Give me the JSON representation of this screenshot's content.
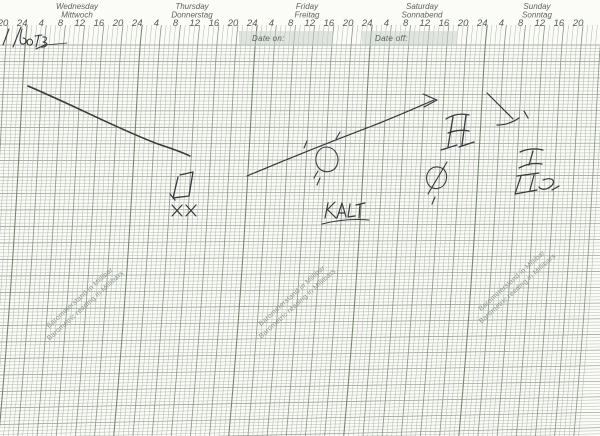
{
  "meta": {
    "title": "Scanned weekly barograph recording chart with handwritten pen annotations",
    "paper_color": "#fbfbf7"
  },
  "colors": {
    "grid_thin": "#adb6ab",
    "grid_major": "#879387",
    "grid_day": "#75826f",
    "header_text": "#5c635a",
    "hour_text": "#555c54",
    "watermark_text": "#8e988d",
    "date_box_fill": "#c8cfc7",
    "pen_ink": "#36393d"
  },
  "header": {
    "days": [
      {
        "en": "Wednesday",
        "de": "Mittwoch"
      },
      {
        "en": "Thursday",
        "de": "Donnerstag"
      },
      {
        "en": "Friday",
        "de": "Freitag"
      },
      {
        "en": "Saturday",
        "de": "Sonnabend"
      },
      {
        "en": "Sunday",
        "de": "Sonntag"
      }
    ],
    "hour_labels": [
      "20",
      "24",
      "4",
      "8",
      "12",
      "16",
      "20",
      "24",
      "4",
      "8",
      "12",
      "16",
      "20",
      "24",
      "4",
      "8",
      "12",
      "16",
      "20",
      "24",
      "4",
      "8",
      "12",
      "16",
      "20",
      "24",
      "4",
      "8",
      "12",
      "16",
      "20"
    ],
    "date_on_label": "Date on:",
    "date_off_label": "Date off:"
  },
  "watermark": {
    "line1": "Barometerstand in Millibar",
    "line2": "Barometric reading in Millibars",
    "instances": [
      {
        "x": 46,
        "y": 331
      },
      {
        "x": 258,
        "y": 329
      },
      {
        "x": 478,
        "y": 314
      }
    ],
    "angle_deg": -42
  },
  "handwriting": {
    "date_note": "1/6/73",
    "front_label": "KALT"
  },
  "chart_data": {
    "type": "line",
    "title": "",
    "x_axis": {
      "unit": "hours",
      "tick_interval_hours": 4,
      "hour_tick_labels": [
        "20",
        "24",
        "4",
        "8",
        "12",
        "16",
        "20",
        "24",
        "4",
        "8",
        "12",
        "16",
        "20",
        "24",
        "4",
        "8",
        "12",
        "16",
        "20",
        "24",
        "4",
        "8",
        "12",
        "16",
        "20",
        "24",
        "4",
        "8",
        "12",
        "16",
        "20"
      ],
      "days": [
        "Wednesday",
        "Thursday",
        "Friday",
        "Saturday",
        "Sunday"
      ]
    },
    "y_axis": {
      "label": "Barometric pressure (millibars)",
      "tick_labels_visible": false
    },
    "grid": {
      "time_lines": "curved hour arcs, heavier every 4 hours, heaviest at midnight (24)",
      "pressure_lines": "dense horizontal rules ~1 mb apart"
    },
    "series": [
      {
        "name": "pen-trace-falling",
        "trend": "falling",
        "start": {
          "day": "Wednesday",
          "hour": 1
        },
        "end": {
          "day": "Thursday",
          "hour": 11
        }
      },
      {
        "name": "pen-trace-rising-arrow",
        "trend": "rising",
        "arrowhead": true,
        "start": {
          "day": "Thursday",
          "hour": 23
        },
        "end": {
          "day": "Saturday",
          "hour": 15
        }
      }
    ],
    "annotations_text": [
      "1/6/73",
      "KALT",
      "Date on:",
      "Date off:"
    ]
  },
  "annotations": {
    "pen": [
      {
        "name": "handwritten-date",
        "w": 1.1,
        "d": "M3 45 L9 29 M13 47 L21 27 M22 29 C20 36 19 43 22 44 C27 45 28 38 23 38 M30 39 C27 39 26 44 29 45 C33 46 34 40 30 39 M35 36 L42 35 M39 35 L36 47 M43 37 C48 36 47 41 43 42 C49 42 47 48 41 47 M36 49 L47 44"
      },
      {
        "name": "handwritten-date-tail",
        "w": 0.7,
        "d": "M46 45 C54 44 60 44 67 43"
      },
      {
        "name": "falling-trace",
        "w": 1.5,
        "d": "M28 86 C75 106 125 132 158 144 C170 148 182 152 190 156"
      },
      {
        "name": "rising-trace",
        "w": 1.2,
        "d": "M247 176 C285 160 330 142 372 126 C398 116 420 106 434 100"
      },
      {
        "name": "rising-trace-arrowhead",
        "w": 1.2,
        "d": "M423 94 L437 100 L424 107"
      },
      {
        "name": "box-symbol",
        "w": 1.3,
        "d": "M180 175 L193 172 L189 196 L173 198 L178 177 M170 194 L175 200"
      },
      {
        "name": "xx-marks",
        "w": 1.2,
        "d": "M172 205 L182 216 M182 205 L172 216 M186 205 L196 216 M196 205 L186 216"
      },
      {
        "name": "circle-symbol",
        "w": 1.1,
        "d": "M327 147 C317 147 313 159 318 167 C323 174 334 173 337 165 C340 157 336 148 327 147 M318 171 L314 178 M320 178 L317 185 M307 141 L304 148 M340 132 L336 139"
      },
      {
        "name": "kalt-word",
        "w": 1.2,
        "d": "M328 203 L325 218 M327 210 L335 202 M328 210 L336 218 M337 218 L342 203 L346 217 M339 213 L345 213 M350 204 L348 217 L355 216 M356 205 L365 203 M360 204 L359 218"
      },
      {
        "name": "kalt-underline",
        "w": 1.1,
        "d": "M322 224 Q345 218 369 220"
      },
      {
        "name": "h-symbol",
        "w": 1.3,
        "d": "M446 119 Q457 112 469 115 M453 117 L448 147 M466 115 L462 145 M448 133 Q459 129 469 131 M441 150 L457 145 M459 147 L474 142"
      },
      {
        "name": "hook-arrow",
        "w": 1.2,
        "d": "M487 93 L513 119 M497 125 Q509 125 519 118 M524 111 L528 118"
      },
      {
        "name": "phi-symbol",
        "w": 1.1,
        "d": "M438 167 C429 166 424 176 428 184 C432 191 443 190 446 181 C448 173 445 168 438 167 M447 162 L428 194 M435 197 L432 204"
      },
      {
        "name": "roman-one-symbol",
        "w": 1.3,
        "d": "M520 152 Q531 147 543 150 M533 151 L529 165 M519 168 Q530 162 542 164"
      },
      {
        "name": "pi-curl-symbol",
        "w": 1.2,
        "d": "M517 176 L539 173 M521 176 L515 194 M515 194 L537 190 M534 175 L530 190 M543 180 C553 176 557 182 550 187 C546 190 541 190 539 187 M552 190 L559 186"
      }
    ]
  }
}
